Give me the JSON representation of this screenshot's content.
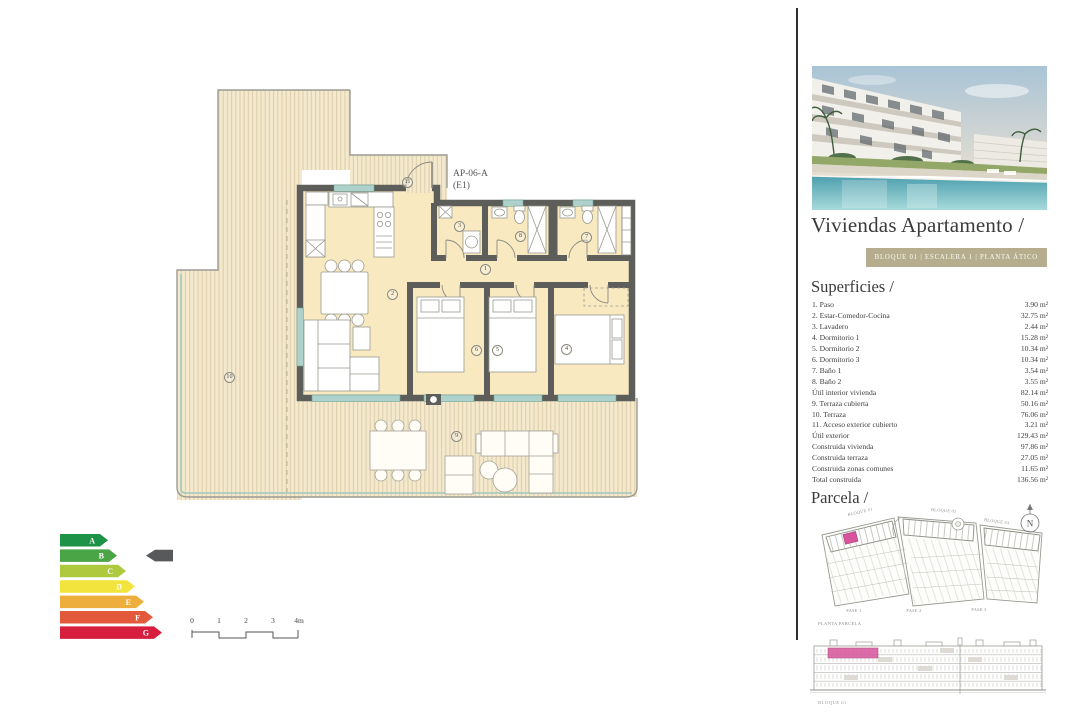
{
  "plan": {
    "unit_label": "AP-06-A",
    "unit_stair": "(E1)",
    "markers": [
      "1",
      "2",
      "3",
      "4",
      "5",
      "6",
      "7",
      "8",
      "9",
      "10",
      "11"
    ]
  },
  "energy": {
    "grades": [
      {
        "letter": "A",
        "color": "#1e9247"
      },
      {
        "letter": "B",
        "color": "#4aa546"
      },
      {
        "letter": "C",
        "color": "#aec93e"
      },
      {
        "letter": "D",
        "color": "#f2e43c"
      },
      {
        "letter": "E",
        "color": "#edae3c"
      },
      {
        "letter": "F",
        "color": "#e2593b"
      },
      {
        "letter": "G",
        "color": "#d81e3f"
      }
    ],
    "selected": "B",
    "indicator_color": "#58595b"
  },
  "scalebar": {
    "ticks": [
      "0",
      "1",
      "2",
      "3",
      "4m"
    ]
  },
  "sidebar": {
    "title": "Viviendas Apartamento /",
    "badge": "BLOQUE 01  |  ESCALERA 1  |  PLANTA ÁTICO",
    "badge_color": "#b5ad8e",
    "superficies": {
      "heading": "Superficies /",
      "rows": [
        {
          "label": "1. Paso",
          "value": "3.90 m²"
        },
        {
          "label": "2. Estar-Comedor-Cocina",
          "value": "32.75 m²"
        },
        {
          "label": "3. Lavadero",
          "value": "2.44 m²"
        },
        {
          "label": "4. Dormitorio 1",
          "value": "15.28 m²"
        },
        {
          "label": "5. Dormitorio 2",
          "value": "10.34 m²"
        },
        {
          "label": "6. Dormitorio 3",
          "value": "10.34 m²"
        },
        {
          "label": "7. Baño 1",
          "value": "3.54 m²"
        },
        {
          "label": "8. Baño 2",
          "value": "3.55 m²"
        },
        {
          "label": "Útil interior vivienda",
          "value": "82.14 m²"
        },
        {
          "label": "9. Terraza cubierta",
          "value": "50.16 m²"
        },
        {
          "label": "10. Terraza",
          "value": "76.06 m²"
        },
        {
          "label": "11. Acceso exterior cubierto",
          "value": "3.21 m²"
        },
        {
          "label": "Útil exterior",
          "value": "129.43 m²"
        },
        {
          "label": "Construida vivienda",
          "value": "97.86 m²"
        },
        {
          "label": "Construida terraza",
          "value": "27.05 m²"
        },
        {
          "label": "Construida zonas comunes",
          "value": "11.65 m²"
        },
        {
          "label": "Total construida",
          "value": "136.56 m²"
        }
      ]
    },
    "parcela": {
      "heading": "Parcela /",
      "north": "N",
      "bloques": [
        "BLOQUE 01",
        "BLOQUE 02",
        "BLOQUE 03"
      ],
      "fases": [
        "FASE 1",
        "FASE 2",
        "FASE 3"
      ],
      "caption": "PLANTA PARCELA",
      "highlight_color": "#d6549c"
    },
    "elevation": {
      "caption": "BLOQUE 01"
    }
  }
}
